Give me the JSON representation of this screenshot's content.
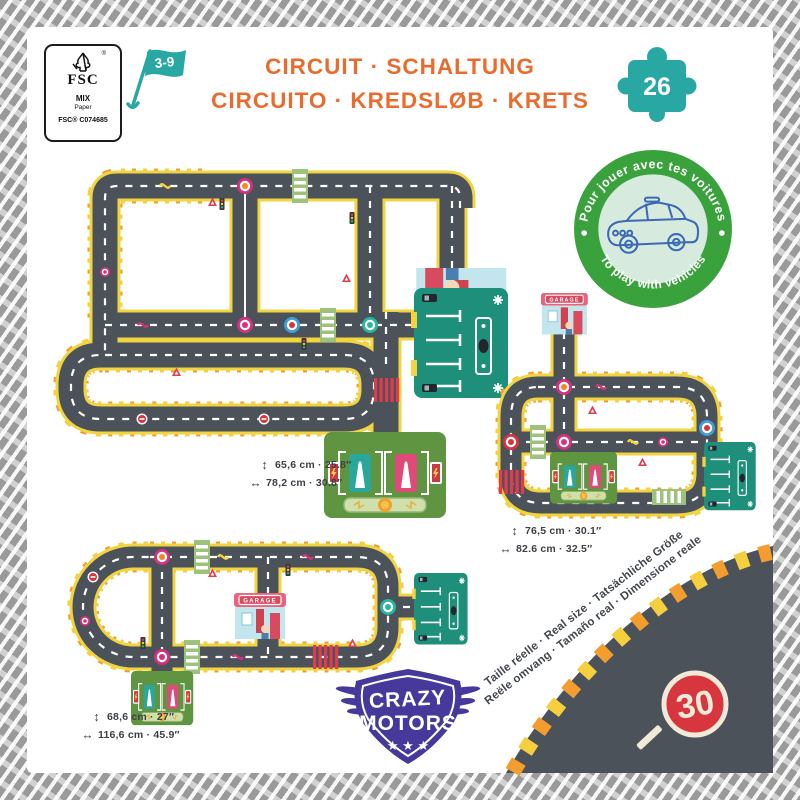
{
  "fsc": {
    "label": "FSC",
    "reg": "®",
    "mix": "MIX",
    "paper": "Paper",
    "code": "FSC® C074685"
  },
  "age_flag": "3-9",
  "title": {
    "line1": "CIRCUIT · SCHALTUNG",
    "line2": "CIRCUITO · KREDSLØB · KRETS"
  },
  "piece_count": "26",
  "play_badge": {
    "top": "Pour jouer avec tes voitures",
    "bottom": "To play with vehicles"
  },
  "garage_label": "GARAGE",
  "dimensions": {
    "circuit1": {
      "height": "65,6 cm · 25.8″",
      "width": "78,2 cm · 30.8″"
    },
    "circuit2": {
      "height": "76,5 cm · 30.1″",
      "width": "82.6 cm · 32.5″"
    },
    "circuit3": {
      "height": "68,6 cm · 27″",
      "width": "116,6 cm · 45.9″"
    }
  },
  "arrows": {
    "vertical": "↕",
    "horizontal": "↔"
  },
  "real_size": {
    "line1": "Taille réelle · Real size · Tatsächliche Größe",
    "line2": "Reële omvang · Tamaño real · Dimensione reale"
  },
  "speed_sign": "30",
  "brand": {
    "top": "CRAZY",
    "bottom": "MOTORS",
    "stars": "★ ★ ★"
  },
  "colors": {
    "title_orange": "#e96b2e",
    "teal": "#29a8a3",
    "badge_green": "#3aa23d",
    "road_gray": "#4b5259",
    "road_yellow": "#f2d441",
    "hazard_orange": "#f39d2f",
    "brand_purple": "#46399b",
    "sign_red": "#d8363f",
    "parking_teal": "#1d8f7b",
    "station_green": "#5f9441"
  }
}
